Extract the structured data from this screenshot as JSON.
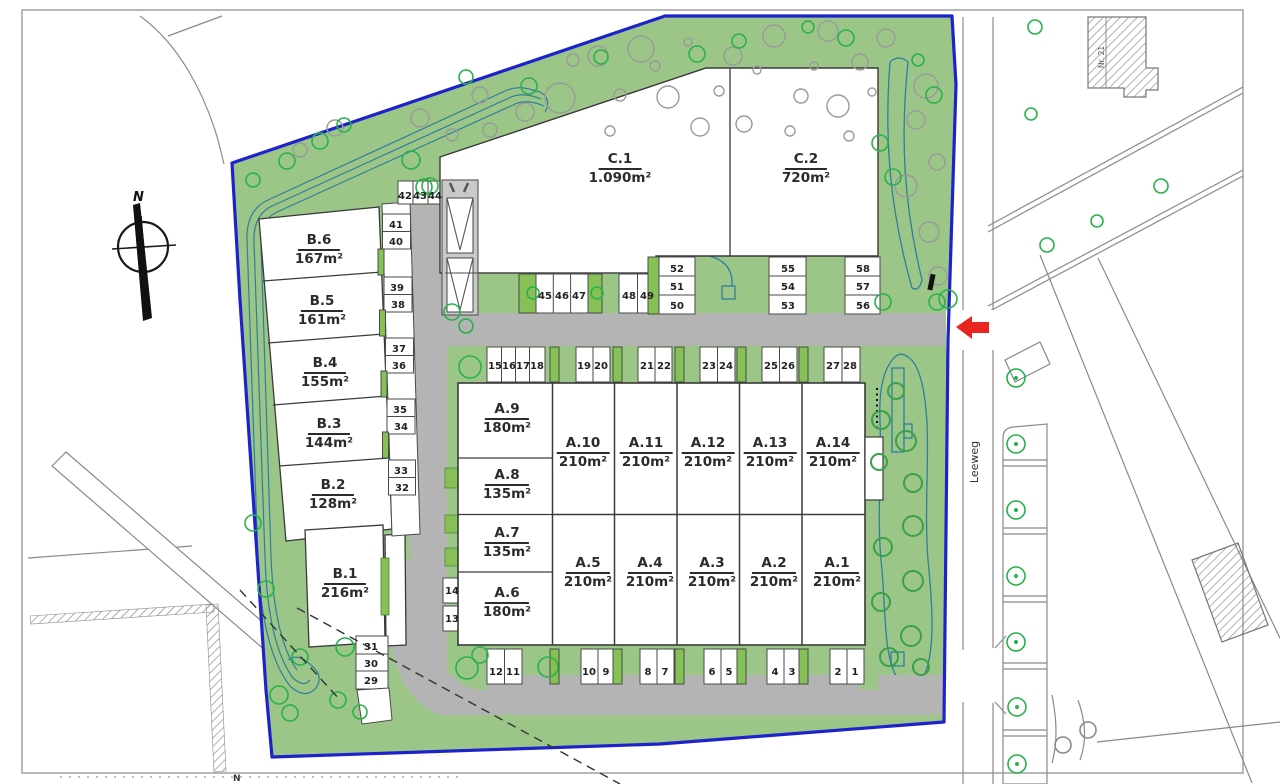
{
  "compass": {
    "label": "N"
  },
  "bottom_north": {
    "label": "N"
  },
  "street": {
    "label": "Leeweg"
  },
  "neighbor_building": {
    "label": "Nr. 21"
  },
  "buildings": {
    "b": [
      {
        "name": "B.6",
        "area": "167m²"
      },
      {
        "name": "B.5",
        "area": "161m²"
      },
      {
        "name": "B.4",
        "area": "155m²"
      },
      {
        "name": "B.3",
        "area": "144m²"
      },
      {
        "name": "B.2",
        "area": "128m²"
      },
      {
        "name": "B.1",
        "area": "216m²"
      }
    ],
    "c": [
      {
        "name": "C.1",
        "area": "1.090m²"
      },
      {
        "name": "C.2",
        "area": "720m²"
      }
    ],
    "a_left": [
      {
        "name": "A.9",
        "area": "180m²"
      },
      {
        "name": "A.8",
        "area": "135m²"
      },
      {
        "name": "A.7",
        "area": "135m²"
      },
      {
        "name": "A.6",
        "area": "180m²"
      }
    ],
    "a_top": [
      {
        "name": "A.10",
        "area": "210m²"
      },
      {
        "name": "A.11",
        "area": "210m²"
      },
      {
        "name": "A.12",
        "area": "210m²"
      },
      {
        "name": "A.13",
        "area": "210m²"
      },
      {
        "name": "A.14",
        "area": "210m²"
      }
    ],
    "a_bottom": [
      {
        "name": "A.5",
        "area": "210m²"
      },
      {
        "name": "A.4",
        "area": "210m²"
      },
      {
        "name": "A.3",
        "area": "210m²"
      },
      {
        "name": "A.2",
        "area": "210m²"
      },
      {
        "name": "A.1",
        "area": "210m²"
      }
    ]
  },
  "parking": {
    "spots": [
      "1",
      "2",
      "3",
      "4",
      "5",
      "6",
      "7",
      "8",
      "9",
      "10",
      "11",
      "12",
      "13",
      "14",
      "15",
      "16",
      "17",
      "18",
      "19",
      "20",
      "21",
      "22",
      "23",
      "24",
      "25",
      "26",
      "27",
      "28",
      "29",
      "30",
      "31",
      "32",
      "33",
      "34",
      "35",
      "36",
      "37",
      "38",
      "39",
      "40",
      "41",
      "42",
      "43",
      "44",
      "45",
      "46",
      "47",
      "48",
      "49",
      "50",
      "51",
      "52",
      "53",
      "54",
      "55",
      "56",
      "57",
      "58"
    ]
  },
  "colors": {
    "site_green": "#9cc687",
    "planter_green": "#85c155",
    "road_gray": "#b4b4b4",
    "boundary_blue": "#1e22cc",
    "path_teal": "#2e7f9e",
    "arrow_red": "#e8251f",
    "tree_green": "#27b24a",
    "tree_gray": "#9a9a9a"
  }
}
